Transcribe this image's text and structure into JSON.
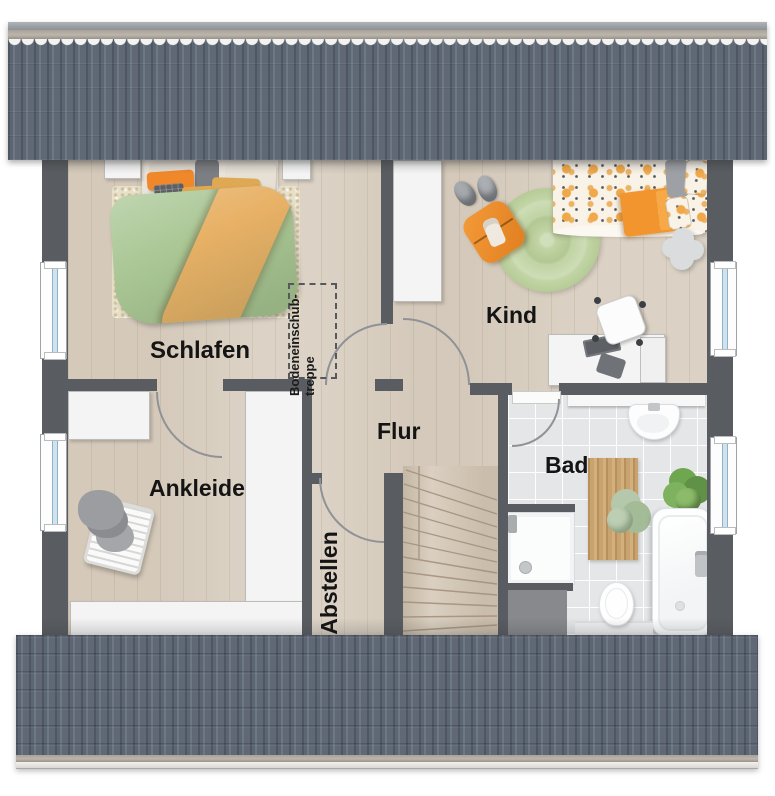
{
  "floor_plan": {
    "rooms": {
      "schlafen": "Schlafen",
      "kind": "Kind",
      "ankleide": "Ankleide",
      "flur": "Flur",
      "abstellen": "Abstellen",
      "bad": "Bad"
    },
    "annotations": {
      "attic_stairs_line1": "Bodeneinschub-",
      "attic_stairs_line2": "treppe"
    },
    "colors": {
      "roof": "#5e6773",
      "walls": "#595d61",
      "wood_floor": "#d8cec0",
      "tile_floor": "#e4e6e8",
      "accent_orange": "#ef8f2e",
      "accent_green": "#aac795"
    }
  }
}
